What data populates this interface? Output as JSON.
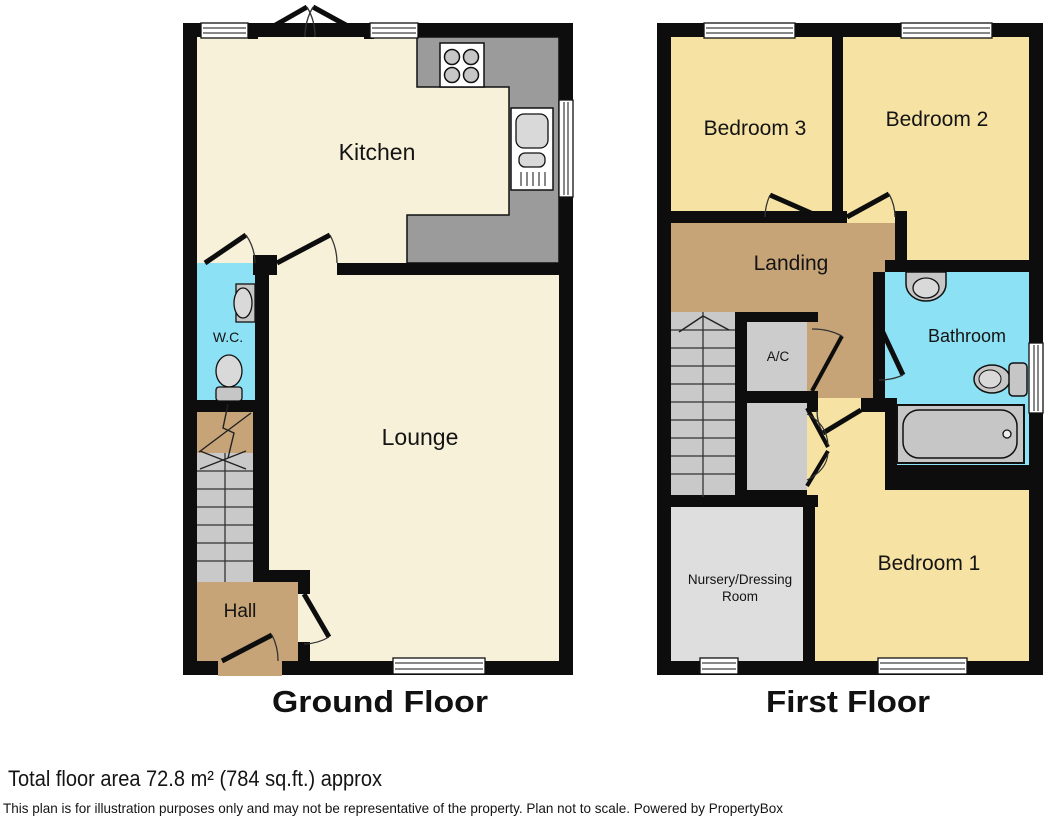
{
  "colors": {
    "wall": "#0d0d0d",
    "cream": "#f7f1da",
    "bedroom": "#f6e3a4",
    "tan": "#c6a478",
    "cyan": "#8ce1f4",
    "stair": "#c9c9c9",
    "counter": "#9b9b9b",
    "closet": "#cccccc",
    "nursery": "#dedede",
    "fixture": "#c6c6c6",
    "fixture_light": "#d9d9d9",
    "window": "#ffffff"
  },
  "ground_floor": {
    "title": "Ground Floor",
    "kitchen": "Kitchen",
    "wc": "W.C.",
    "lounge": "Lounge",
    "hall": "Hall"
  },
  "first_floor": {
    "title": "First Floor",
    "bedroom3": "Bedroom 3",
    "bedroom2": "Bedroom 2",
    "landing": "Landing",
    "ac": "A/C",
    "bathroom": "Bathroom",
    "nursery1": "Nursery/Dressing",
    "nursery2": "Room",
    "bedroom1": "Bedroom 1"
  },
  "footer": {
    "area": "Total floor area 72.8 m² (784 sq.ft.) approx",
    "disclaimer": "This plan is for illustration purposes only and may not be representative of the property. Plan not to scale. Powered by PropertyBox"
  }
}
